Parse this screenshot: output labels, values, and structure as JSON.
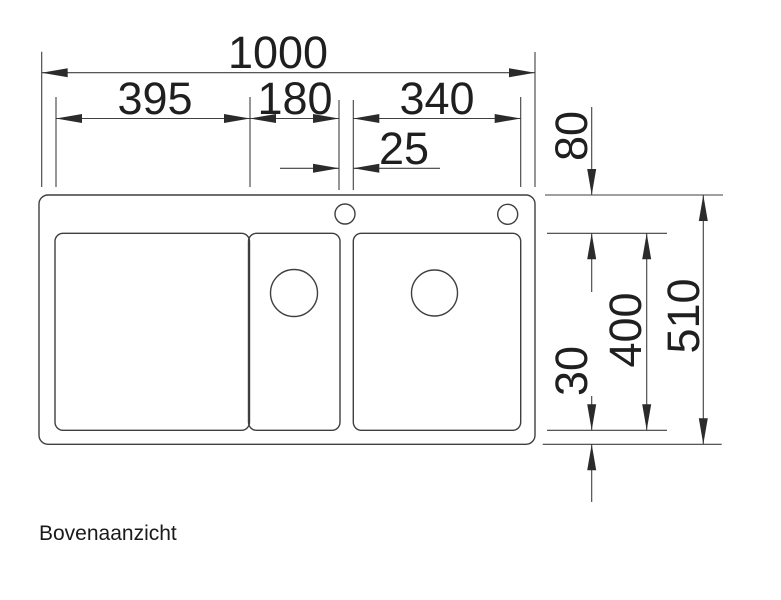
{
  "diagram": {
    "caption": "Bovenaanzicht",
    "dims": {
      "total_width": "1000",
      "left_section_width": "395",
      "middle_bowl_width": "180",
      "right_bowl_width": "340",
      "bowl_gap": "25",
      "top_rim_offset": "80",
      "total_depth": "510",
      "bowl_depth": "400",
      "bottom_rim_offset": "30"
    },
    "colors": {
      "line": "#3f3f3f",
      "text": "#1f1f1f",
      "background": "#ffffff"
    }
  }
}
